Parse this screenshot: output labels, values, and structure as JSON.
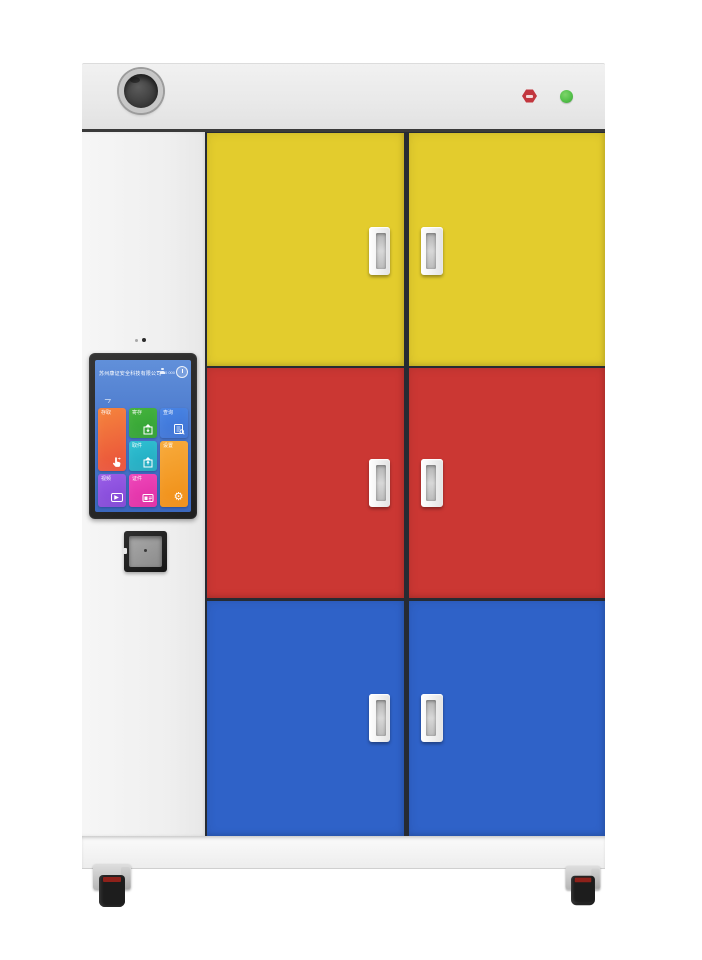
{
  "device": {
    "name": "smart locker cabinet",
    "status_led_color": "#54c14a",
    "brand_badge_color": "#c2363e",
    "door_row_colors": [
      "#e3cc2d",
      "#cb3733",
      "#2f62c8"
    ],
    "frame_color": "#f0f0f0"
  },
  "screen": {
    "header": {
      "company": "苏州康证安全科技有限公司",
      "user_status": "00 000"
    },
    "tiles": [
      {
        "label": "存取",
        "icon": "touch-hand-icon"
      },
      {
        "label": "寄存",
        "icon": "locker-in-icon"
      },
      {
        "label": "查询",
        "icon": "record-search-icon"
      },
      {
        "label": "取件",
        "icon": "locker-out-icon"
      },
      {
        "label": "设置",
        "icon": "gear-icon"
      },
      {
        "label": "视频",
        "icon": "video-play-icon"
      },
      {
        "label": "证件",
        "icon": "id-card-icon"
      }
    ]
  },
  "icons": {
    "gear": "⚙",
    "video_play": "▶"
  }
}
